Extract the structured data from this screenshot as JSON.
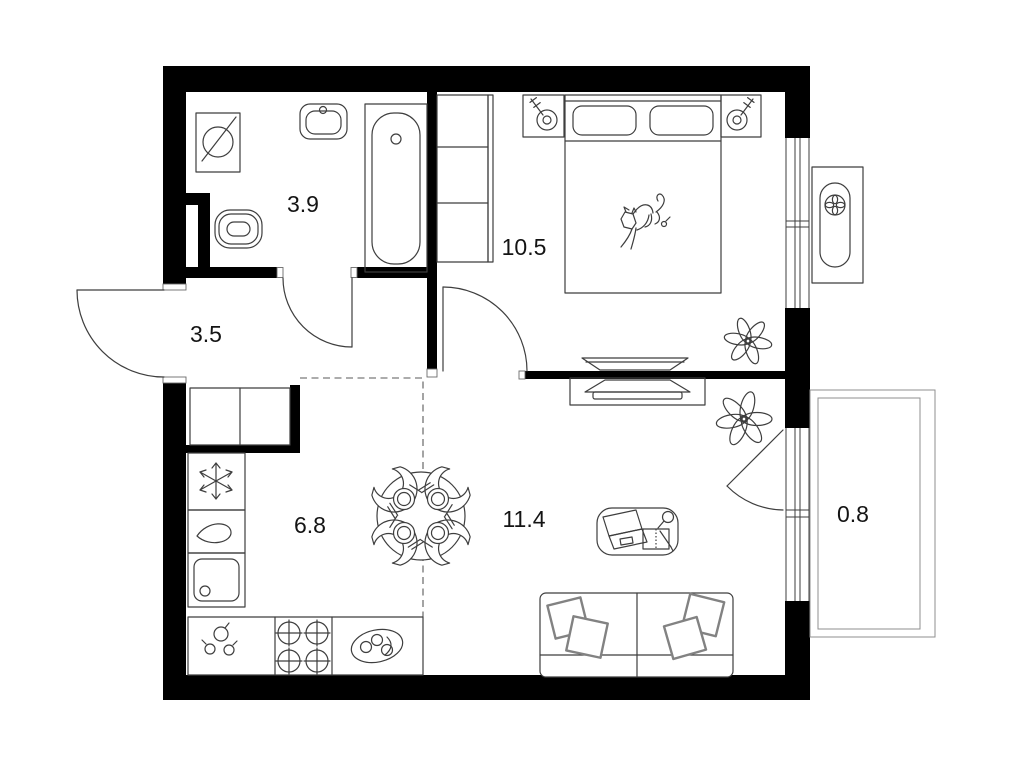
{
  "plan": {
    "rooms": [
      {
        "id": "bathroom",
        "area_label": "3.9"
      },
      {
        "id": "bedroom",
        "area_label": "10.5"
      },
      {
        "id": "hallway",
        "area_label": "3.5"
      },
      {
        "id": "kitchen",
        "area_label": "6.8"
      },
      {
        "id": "living-room",
        "area_label": "11.4"
      },
      {
        "id": "balcony",
        "area_label": "0.8"
      }
    ],
    "colors": {
      "walls": "#000000",
      "furniture_line": "#3e3e3e",
      "light_line": "#8f8f8f",
      "text": "#141414",
      "background": "#ffffff"
    }
  }
}
